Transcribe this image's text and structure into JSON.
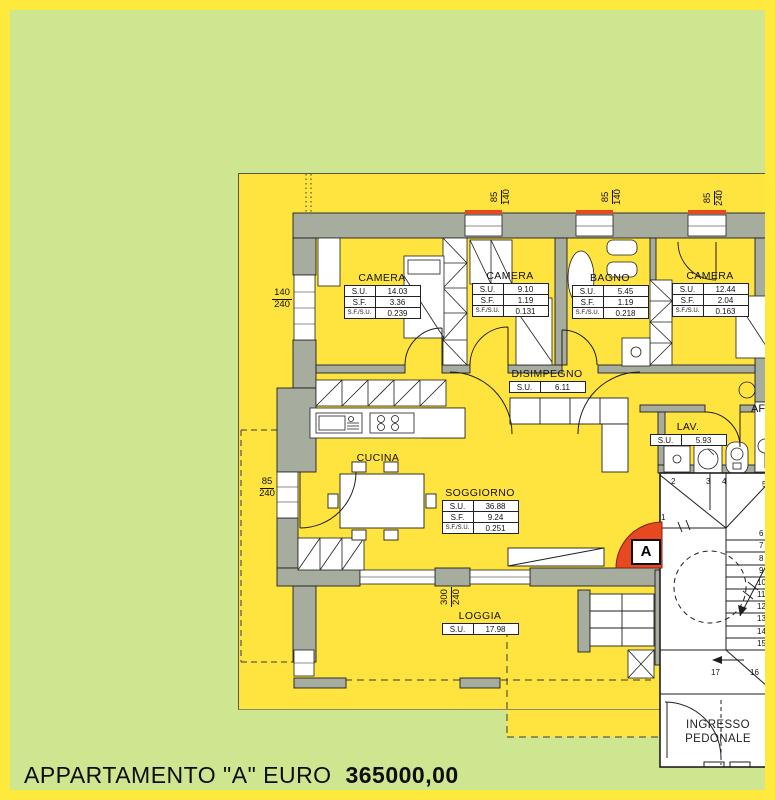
{
  "title_bar": {
    "label": "APPARTAMENTO \"A\" EURO",
    "price": "365000,00"
  },
  "marker": {
    "label": "A"
  },
  "stat_keys": {
    "su": "S.U.",
    "sf": "S.F.",
    "sfsu": "S.F./S.U."
  },
  "rooms": [
    {
      "name": "CAMERA",
      "su": "14.03",
      "sf": "3.36",
      "sfsu": "0.239"
    },
    {
      "name": "CAMERA",
      "su": "9.10",
      "sf": "1.19",
      "sfsu": "0.131"
    },
    {
      "name": "BAGNO",
      "su": "5.45",
      "sf": "1.19",
      "sfsu": "0.218"
    },
    {
      "name": "CAMERA",
      "su": "12.44",
      "sf": "2.04",
      "sfsu": "0.163"
    },
    {
      "name": "DISIMPEGNO",
      "su": "6.11"
    },
    {
      "name": "CUCINA"
    },
    {
      "name": "SOGGIORNO",
      "su": "36.88",
      "sf": "9.24",
      "sfsu": "0.251"
    },
    {
      "name": "LAV.",
      "su": "5.93"
    },
    {
      "name": "LOGGIA",
      "su": "17.98"
    }
  ],
  "dimensions": [
    {
      "w": "85",
      "h": "140"
    },
    {
      "w": "85",
      "h": "140"
    },
    {
      "w": "85",
      "h": "240"
    },
    {
      "w": "140",
      "h": "240"
    },
    {
      "w": "85",
      "h": "240"
    },
    {
      "w": "300",
      "h": "240"
    }
  ],
  "annotations": {
    "af": "AF",
    "entrance": "INGRESSO PEDONALE"
  },
  "stairs": {
    "numbers": [
      "1",
      "2",
      "3",
      "4",
      "5",
      "6",
      "7",
      "8",
      "9",
      "10",
      "11",
      "12",
      "13",
      "14",
      "15",
      "16",
      "17"
    ]
  },
  "colors": {
    "frame": "#ffe93c",
    "ground": "#cde68f",
    "plan": "#ffe33f",
    "wall": "#a6ad9e",
    "accent_red": "#e8481f"
  }
}
